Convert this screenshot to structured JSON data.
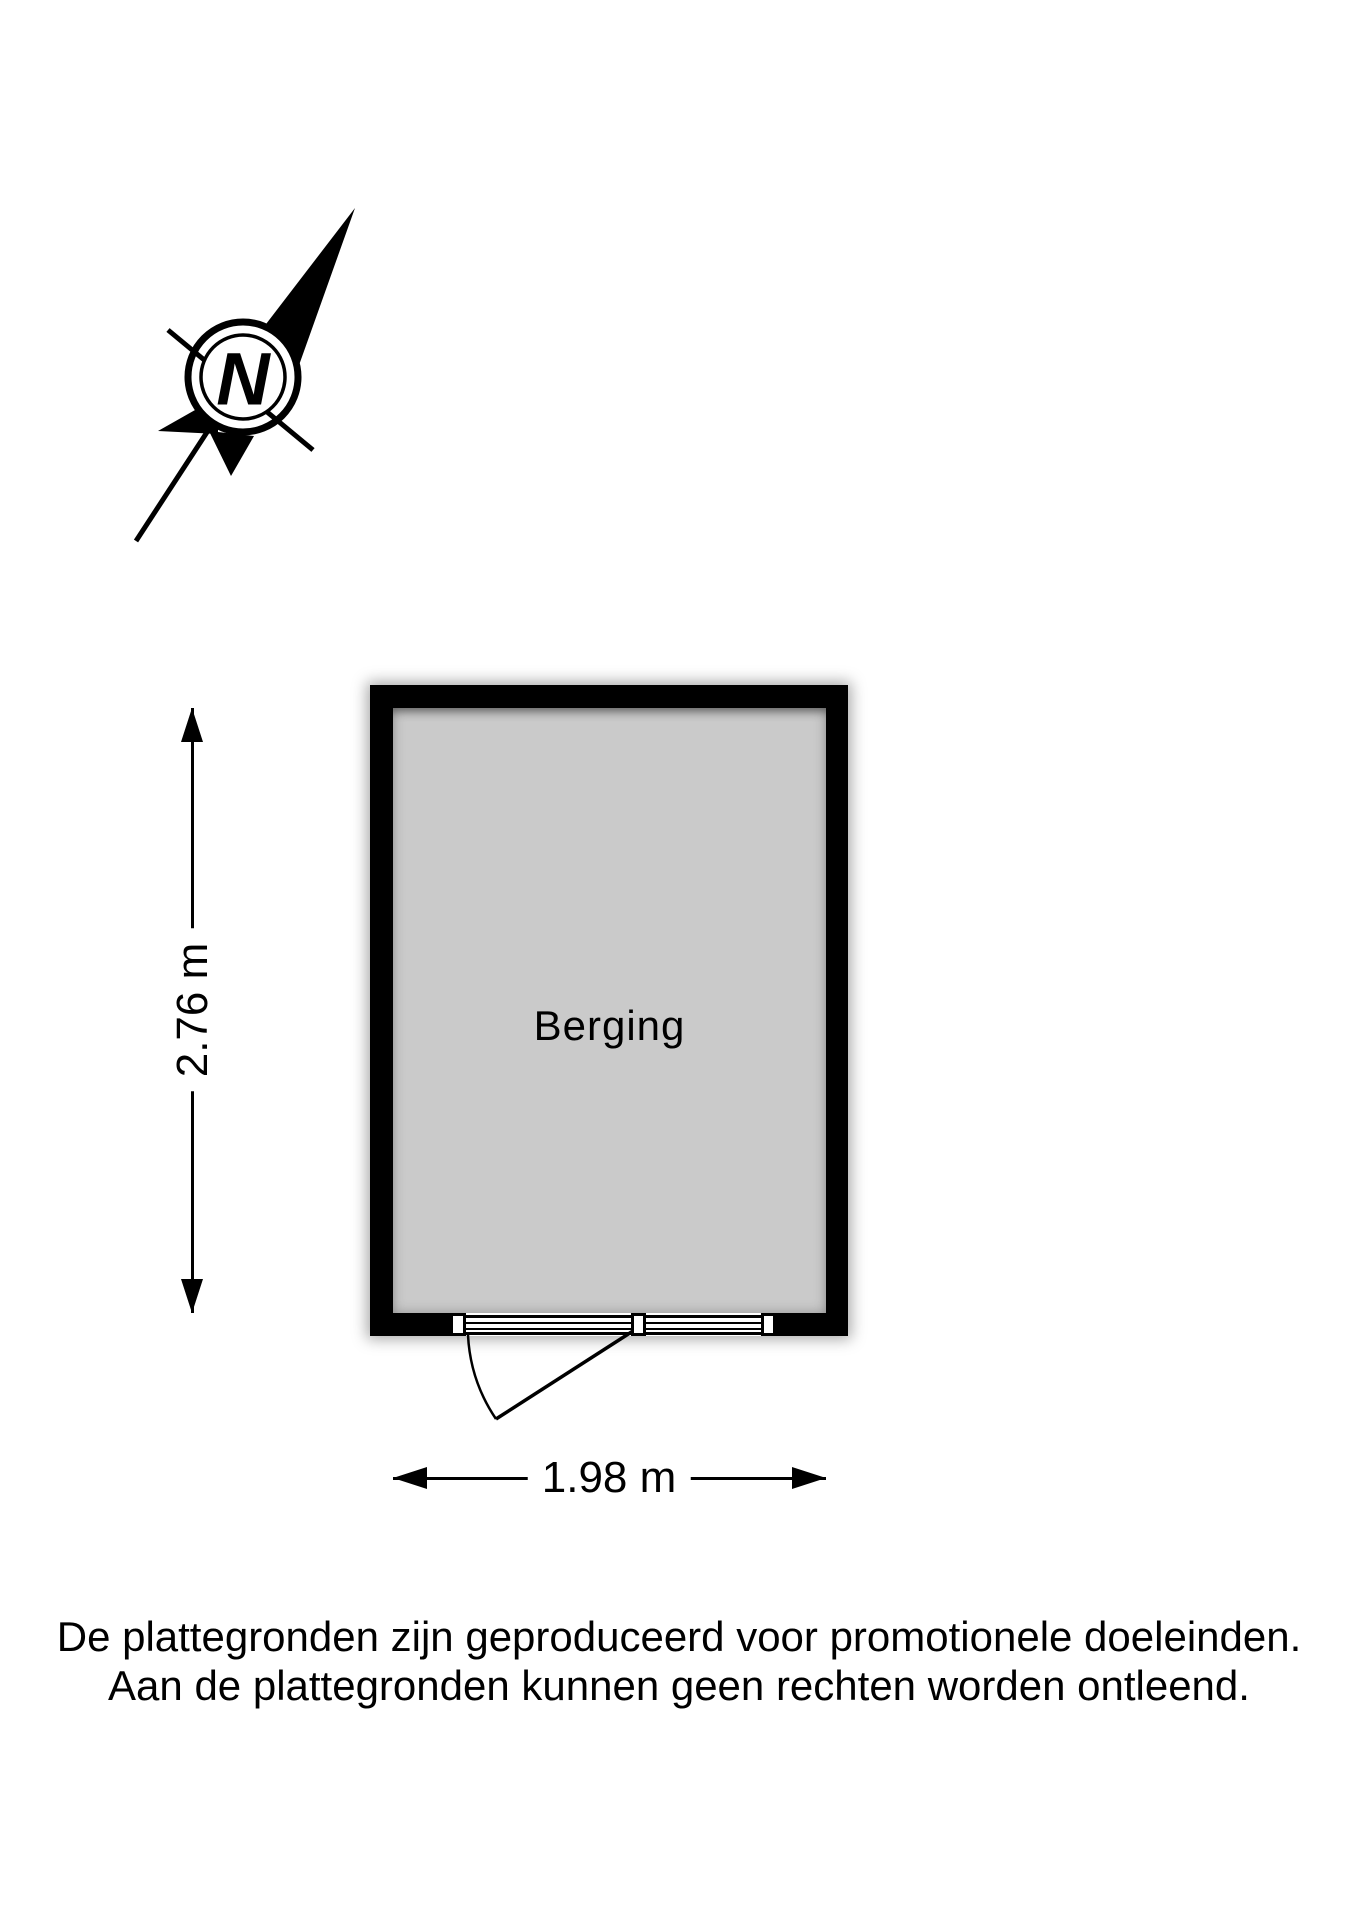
{
  "compass": {
    "letter": "N"
  },
  "room": {
    "label": "Berging",
    "width_m": "1.98",
    "height_m": "2.76"
  },
  "dimensions": {
    "height_label": "2.76 m",
    "width_label": "1.98 m"
  },
  "disclaimer": {
    "line1": "De plattegronden zijn geproduceerd voor promotionele doeleinden.",
    "line2": "Aan de plattegronden kunnen geen rechten worden ontleend."
  },
  "colors": {
    "wall": "#000000",
    "room_fill": "#cacaca",
    "background": "#ffffff",
    "text": "#000000"
  }
}
